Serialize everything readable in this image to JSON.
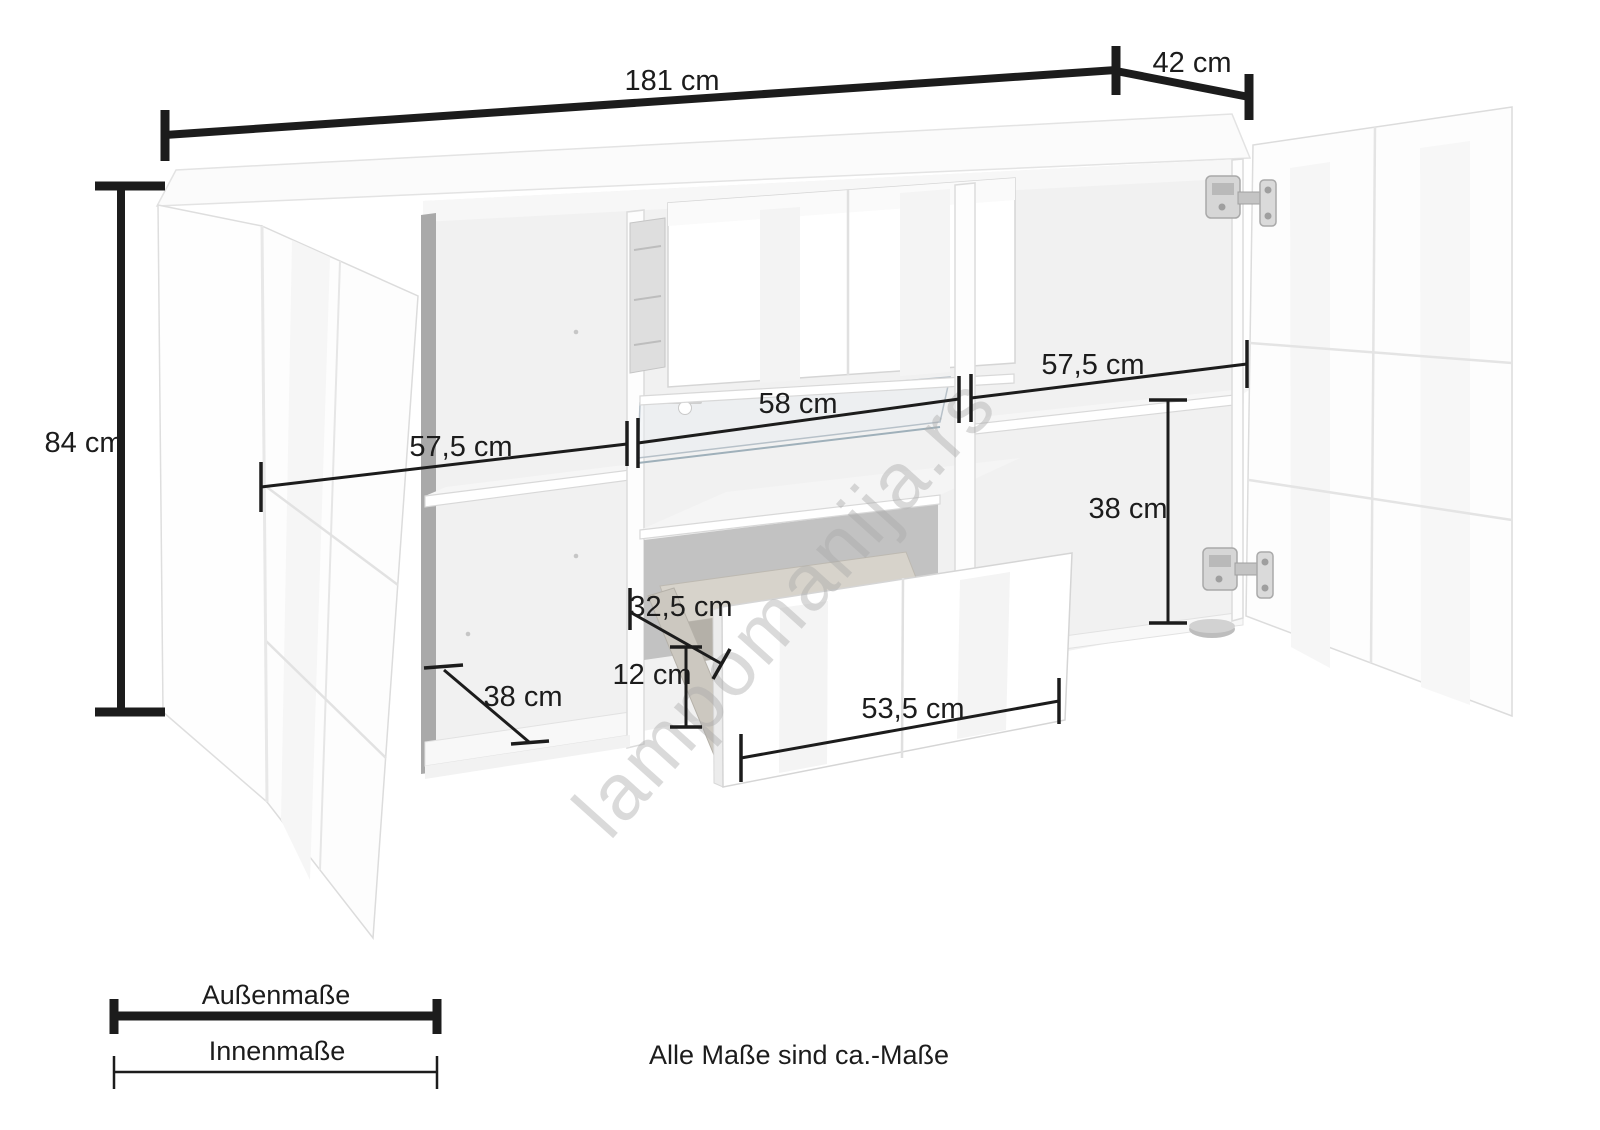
{
  "diagram": {
    "title_hint": "Sideboard dimension drawing",
    "watermark": "lampomanija.rs",
    "note": "Alle Maße sind ca.-Maße",
    "legend": {
      "outer_label": "Außenmaße",
      "inner_label": "Innenmaße"
    },
    "dimensions": {
      "total_width": "181 cm",
      "total_depth": "42 cm",
      "total_height": "84 cm",
      "left_inner_width": "57,5 cm",
      "center_inner_width": "58 cm",
      "right_inner_width": "57,5 cm",
      "right_inner_height": "38 cm",
      "drawer_inner_depth": "32,5 cm",
      "drawer_inner_height": "12 cm",
      "left_inner_depth": "38 cm",
      "drawer_front_width": "53,5 cm"
    },
    "colors": {
      "dimension_line": "#1c1c1c",
      "watermark": "#a9a9a9",
      "furniture_edge": "#d9d9d9",
      "background": "#ffffff"
    }
  }
}
